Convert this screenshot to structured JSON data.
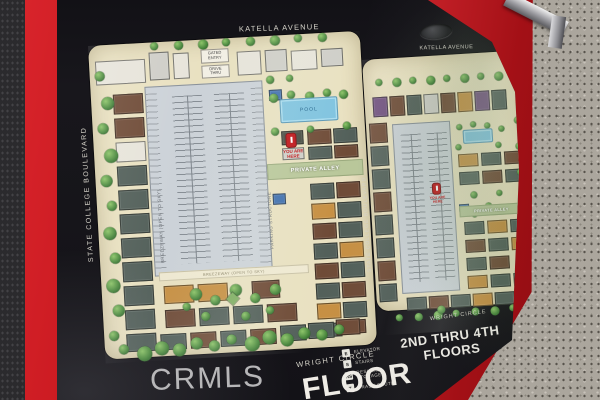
{
  "photo": {
    "watermark": "CRMLS",
    "floor_label": "FLOOR",
    "legend": {
      "items": [
        {
          "symbol": "E",
          "label": "ELEVATOR"
        },
        {
          "symbol": "S",
          "label": "STAIRS"
        },
        {
          "symbol": "RS",
          "label": "RESIDENT STORAGE"
        },
        {
          "symbol": "T",
          "label": "TRASH CHUTE"
        }
      ]
    },
    "plans": {
      "first_floor": {
        "street_top": "KATELLA AVENUE",
        "street_left": "STATE COLLEGE BOULEVARD",
        "street_bottom": "WRIGHT CIRCLE",
        "private_alley": "PRIVATE ALLEY",
        "pool": "POOL",
        "gated_entry": "GATED ENTRY",
        "drive_thru": "DRIVE THRU",
        "parking_structure": "PARKING STRUCTURE",
        "breezeway": "BREEZEWAY (OPEN TO SKY)",
        "you_are_here": "YOU ARE HERE"
      },
      "upper_floors": {
        "title": "2ND THRU 4TH FLOORS",
        "street_top": "KATELLA AVENUE",
        "street_left": "STATE COLLEGE BOULEVARD",
        "street_bottom": "WRIGHT CIRCLE",
        "private_alley": "PRIVATE ALLEY",
        "you_are_here": "YOU ARE HERE"
      }
    },
    "colors": {
      "frame_red": "#c3161d",
      "sign_black": "#141317",
      "map_cream": "#e9e1c1",
      "pool_blue": "#7fc3e0",
      "tree_green": "#4c8a3f",
      "concrete_gray": "#aba69d"
    }
  }
}
